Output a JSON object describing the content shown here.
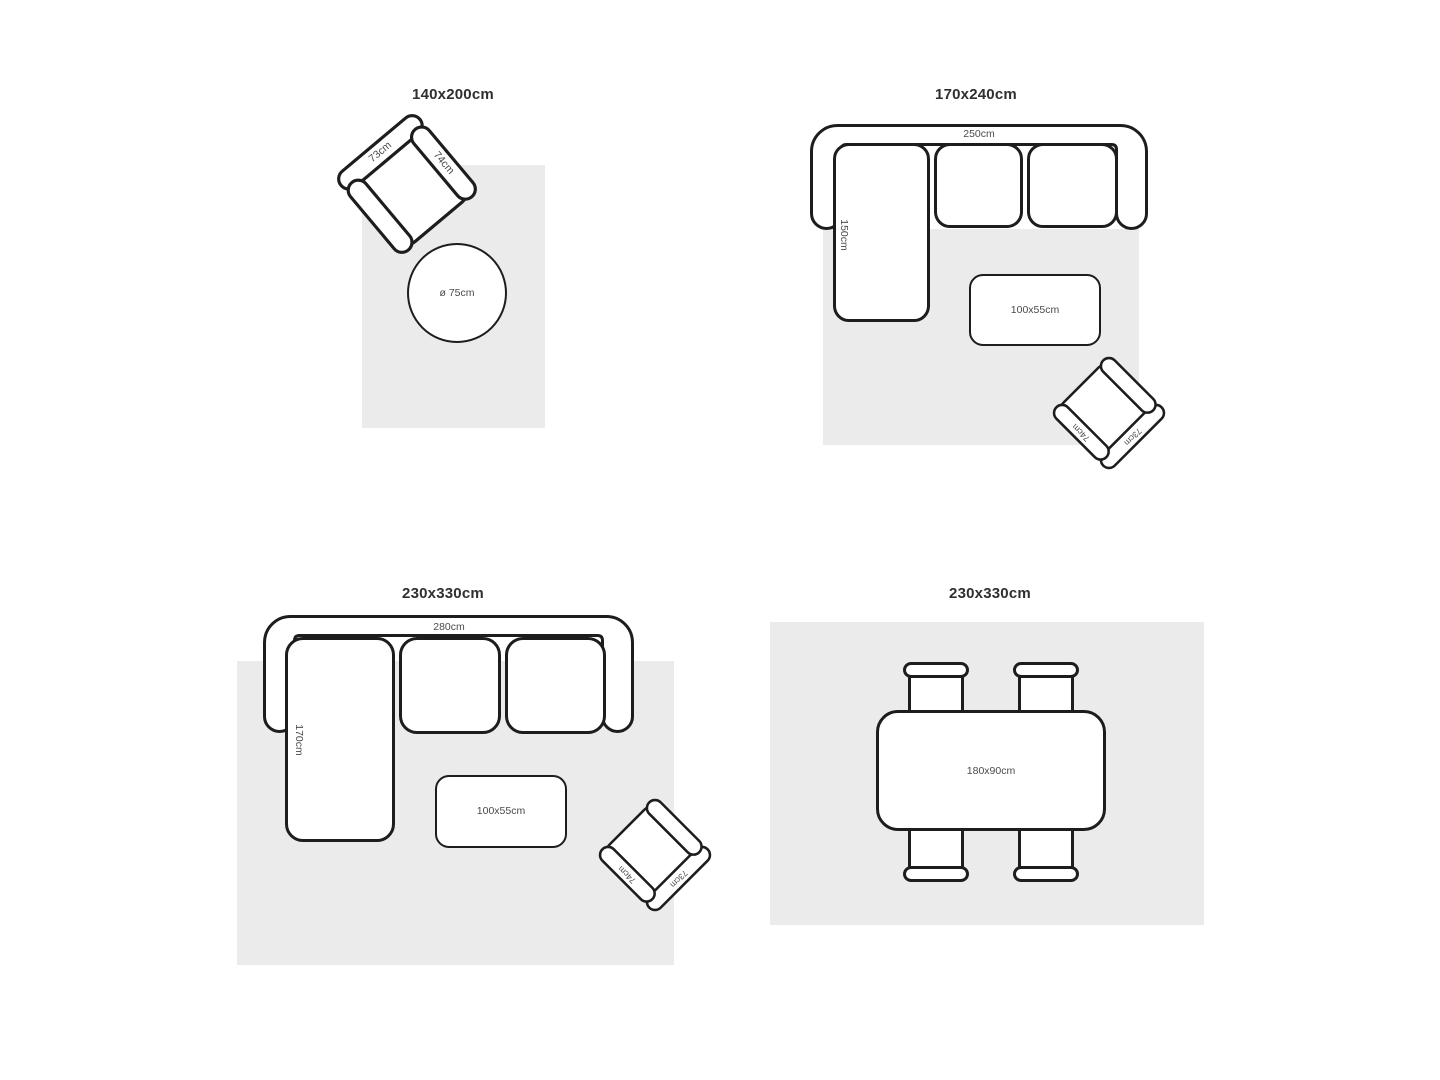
{
  "colors": {
    "outline": "#1d1d1d",
    "rug": "#ebebeb",
    "label": "#4a4a4a",
    "title": "#2f2f2f"
  },
  "panels": [
    {
      "title": "140x200cm",
      "armchair": {
        "back_label": "73cm",
        "arm_label": "74cm"
      },
      "round_table": {
        "label": "ø 75cm"
      }
    },
    {
      "title": "170x240cm",
      "sofa": {
        "length_label": "250cm",
        "chaise_label": "150cm"
      },
      "coffee_table": {
        "label": "100x55cm"
      },
      "armchair": {
        "back_label": "73cm",
        "arm_label": "74cm"
      }
    },
    {
      "title": "230x330cm",
      "sofa": {
        "length_label": "280cm",
        "chaise_label": "170cm"
      },
      "coffee_table": {
        "label": "100x55cm"
      },
      "armchair": {
        "back_label": "73cm",
        "arm_label": "74cm"
      }
    },
    {
      "title": "230x330cm",
      "dining_table": {
        "label": "180x90cm"
      }
    }
  ]
}
